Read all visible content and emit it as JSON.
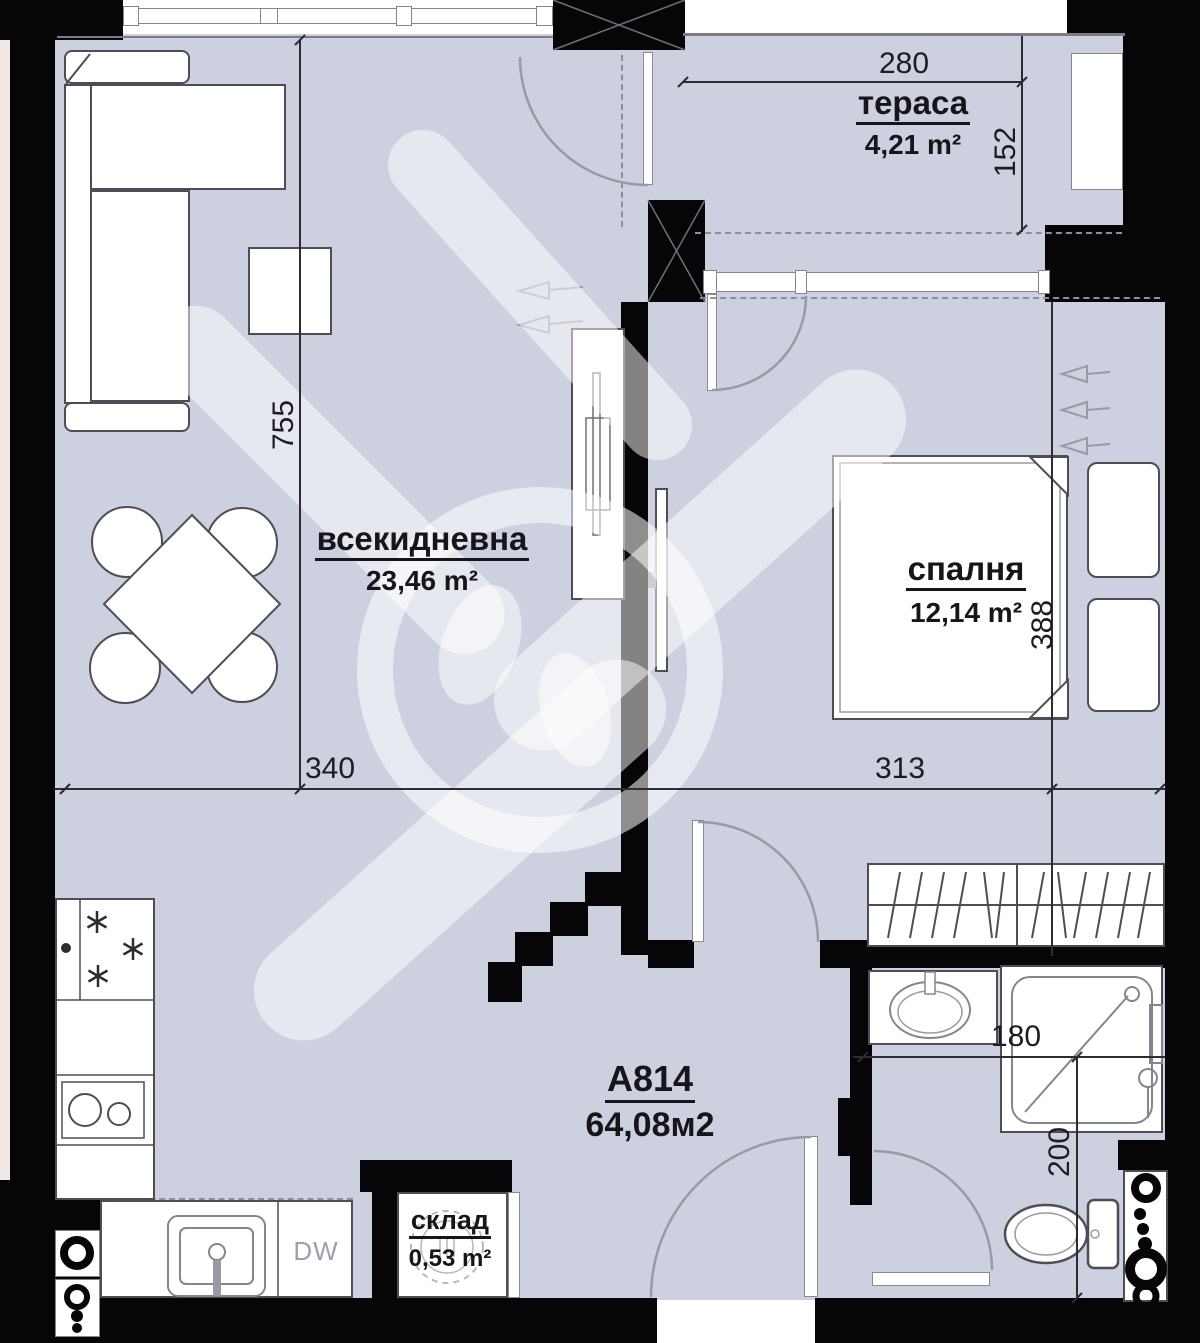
{
  "plan": {
    "unit": {
      "label": "А814",
      "area": "64,08м2"
    },
    "rooms": {
      "terrace": {
        "name": "тераса",
        "area": "4,21 m²"
      },
      "living": {
        "name": "всекидневна",
        "area": "23,46 m²"
      },
      "bedroom": {
        "name": "спалня",
        "area": "12,14 m²"
      },
      "storage": {
        "name": "склад",
        "area": "0,53 m²"
      }
    },
    "dims": {
      "terrace_width": "280",
      "terrace_depth": "152",
      "living_length": "755",
      "living_width": "340",
      "bedroom_width": "313",
      "bedroom_length": "388",
      "bath_width": "180",
      "bath_depth": "200"
    },
    "labels": {
      "dishwasher": "DW"
    },
    "colors": {
      "floor": "#ccd0df",
      "wall": "#060608",
      "adjacent_unit": "#f2e8e4"
    }
  }
}
